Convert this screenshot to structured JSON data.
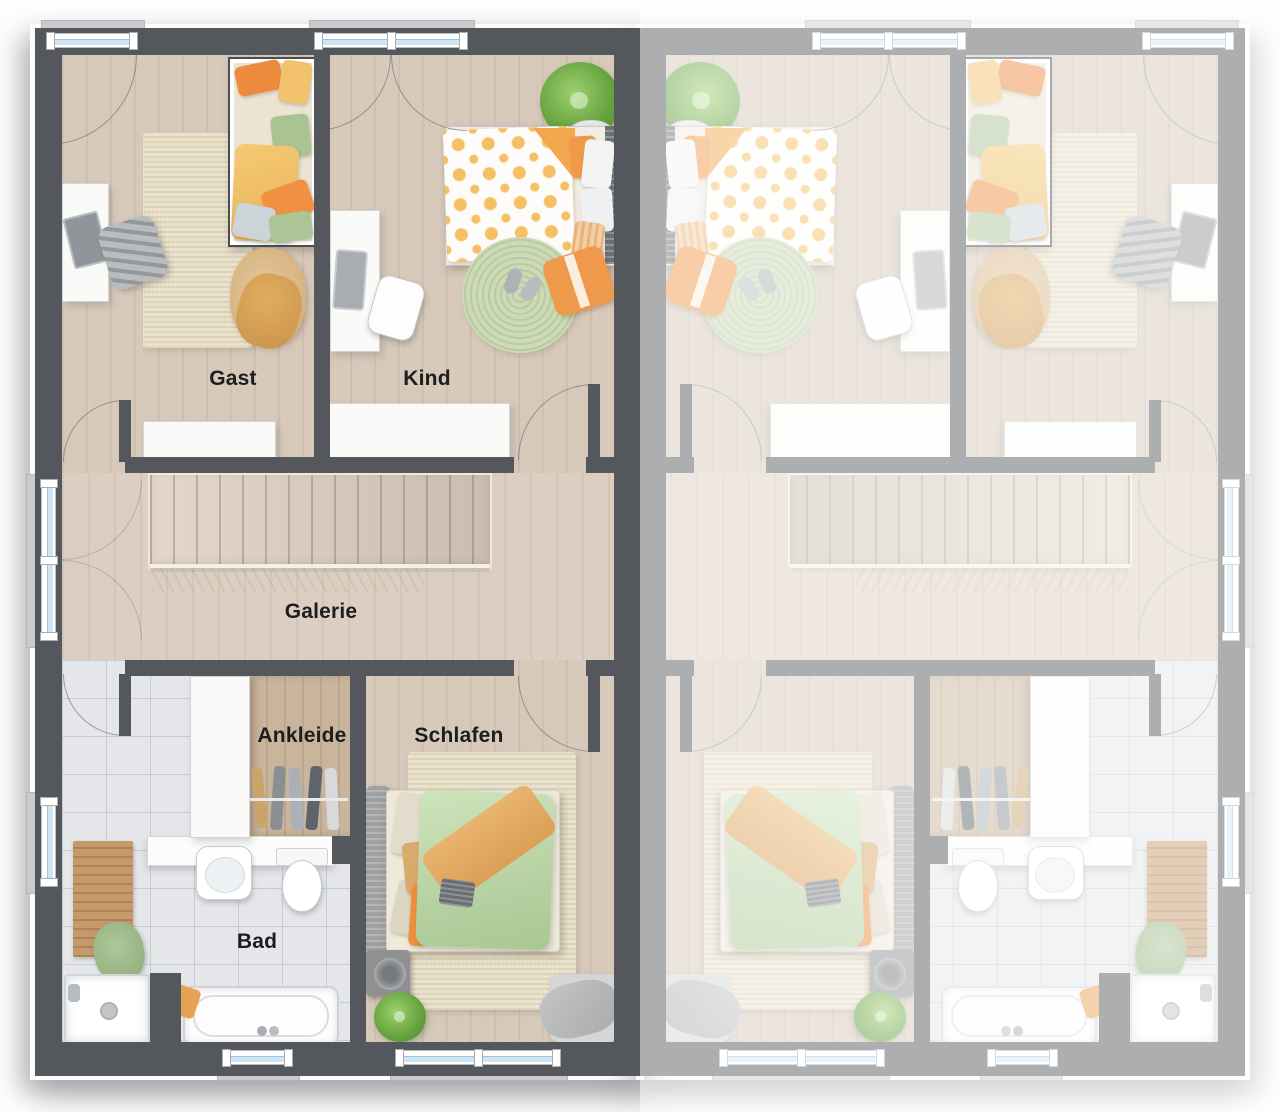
{
  "rooms": {
    "gast": {
      "label": "Gast"
    },
    "kind": {
      "label": "Kind"
    },
    "galerie": {
      "label": "Galerie"
    },
    "ankleide": {
      "label": "Ankleide"
    },
    "schlafen": {
      "label": "Schlafen"
    },
    "bad": {
      "label": "Bad"
    }
  },
  "units": {
    "left": {
      "appearance": "full-color"
    },
    "right": {
      "appearance": "mirrored, faded, unlabeled"
    }
  },
  "colors": {
    "wall_dark": "#54575b",
    "wall_faded": "#a8abae",
    "floor_wood": "#d7c9ba",
    "floor_wood_closet": "#c9b49c",
    "floor_tile": "#e4e6e9",
    "window_glass": "#cfe4f2",
    "window_sill": "#c8cacc",
    "accent_orange": "#ef9a4a",
    "accent_yellow": "#f0c46a",
    "accent_green": "#b5cfa0",
    "rug_beige": "#e9e1ca",
    "rug_green": "#ccdab6",
    "label_text": "#1d1d1f"
  }
}
